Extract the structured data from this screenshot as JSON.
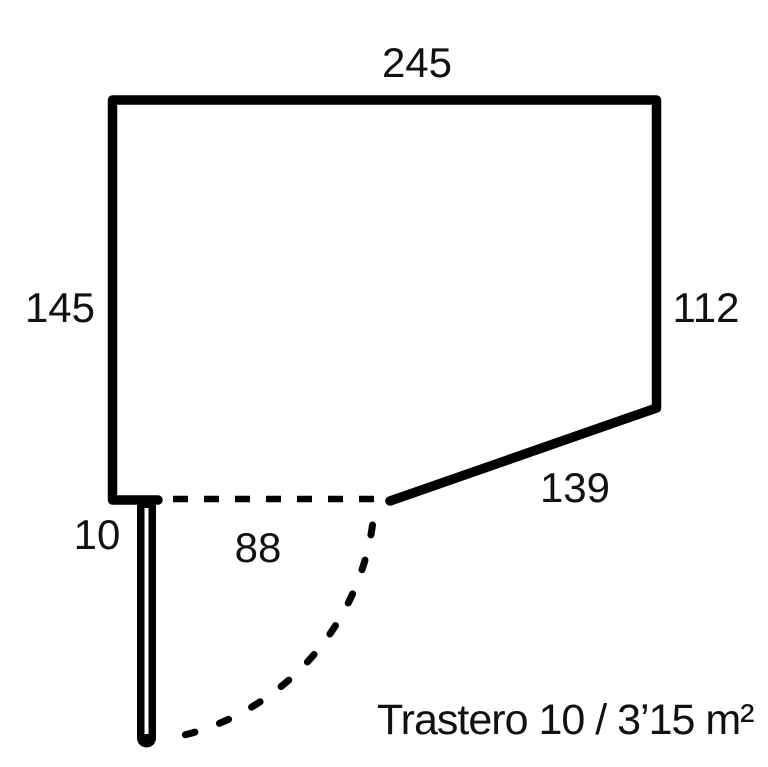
{
  "floorplan": {
    "caption": "Trastero 10 / 3’15 m²",
    "dimension_labels": {
      "top_wall": "245",
      "left_wall": "145",
      "right_wall": "112",
      "diagonal_wall": "139",
      "door_jamb": "10",
      "door_opening": "88"
    },
    "colors": {
      "background": "#ffffff",
      "walls": "#000000",
      "text": "#111111"
    }
  }
}
